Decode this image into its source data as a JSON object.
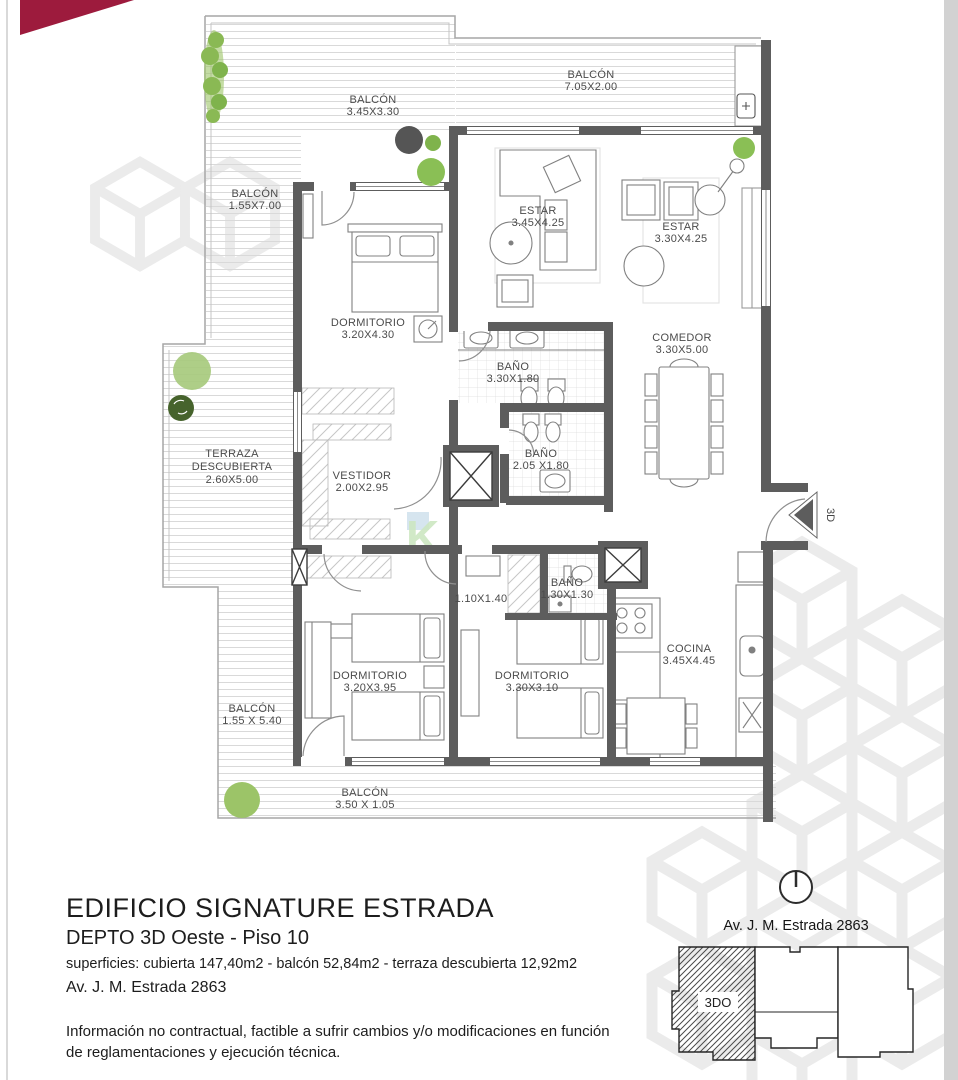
{
  "document": {
    "title": "EDIFICIO SIGNATURE ESTRADA",
    "subtitle": "DEPTO 3D  Oeste - Piso 10",
    "surfaces_line": "superficies: cubierta   147,40m2 - balcón 52,84m2 - terraza descubierta 12,92m2",
    "address_line": "Av. J. M. Estrada  2863",
    "disclaimer_line1": "Información no contractual, factible a sufrir cambios y/o modificaciones en función",
    "disclaimer_line2": "de reglamentaciones y ejecución técnica."
  },
  "plan": {
    "rooms": {
      "balcon_top": {
        "name": "BALCÓN",
        "dims": "3.45X3.30"
      },
      "balcon_top_right": {
        "name": "BALCÓN",
        "dims": "7.05X2.00"
      },
      "balcon_left": {
        "name": "BALCÓN",
        "dims": "1.55X7.00"
      },
      "estar_left": {
        "name": "ESTAR",
        "dims": "3.45X4.25"
      },
      "estar_right": {
        "name": "ESTAR",
        "dims": "3.30X4.25"
      },
      "dormitorio_principal": {
        "name": "DORMITORIO",
        "dims": "3.20X4.30"
      },
      "bano_principal": {
        "name": "BAÑO",
        "dims": "3.30X1.80"
      },
      "comedor": {
        "name": "COMEDOR",
        "dims": "3.30X5.00"
      },
      "bano_2": {
        "name": "BAÑO",
        "dims": "2.05 X1.80"
      },
      "terraza": {
        "name": "TERRAZA",
        "name2": "DESCUBIERTA",
        "dims": "2.60X5.00"
      },
      "vestidor": {
        "name": "VESTIDOR",
        "dims": "2.00X2.95"
      },
      "lavadero": {
        "dims": "1.10X1.40"
      },
      "bano_3": {
        "name": "BAÑO",
        "dims": "1.30X1.30"
      },
      "dormitorio_2": {
        "name": "DORMITORIO",
        "dims": "3.20X3.95"
      },
      "dormitorio_3": {
        "name": "DORMITORIO",
        "dims": "3.30X3.10"
      },
      "cocina": {
        "name": "COCINA",
        "dims": "3.45X4.45"
      },
      "balcon_left_lower": {
        "name": "BALCÓN",
        "dims": "1.55 X 5.40"
      },
      "balcon_bottom": {
        "name": "BALCÓN",
        "dims": "3.50 X 1.05"
      }
    },
    "entrance_marker": "3D"
  },
  "keyplan": {
    "address": "Av. J. M. Estrada  2863",
    "unit": "3DO"
  },
  "colors": {
    "wall": "#5d5d5d",
    "accent_red": "#9d1b3d",
    "tree_green": "#8ab954",
    "watermark": "#ebebeb"
  }
}
